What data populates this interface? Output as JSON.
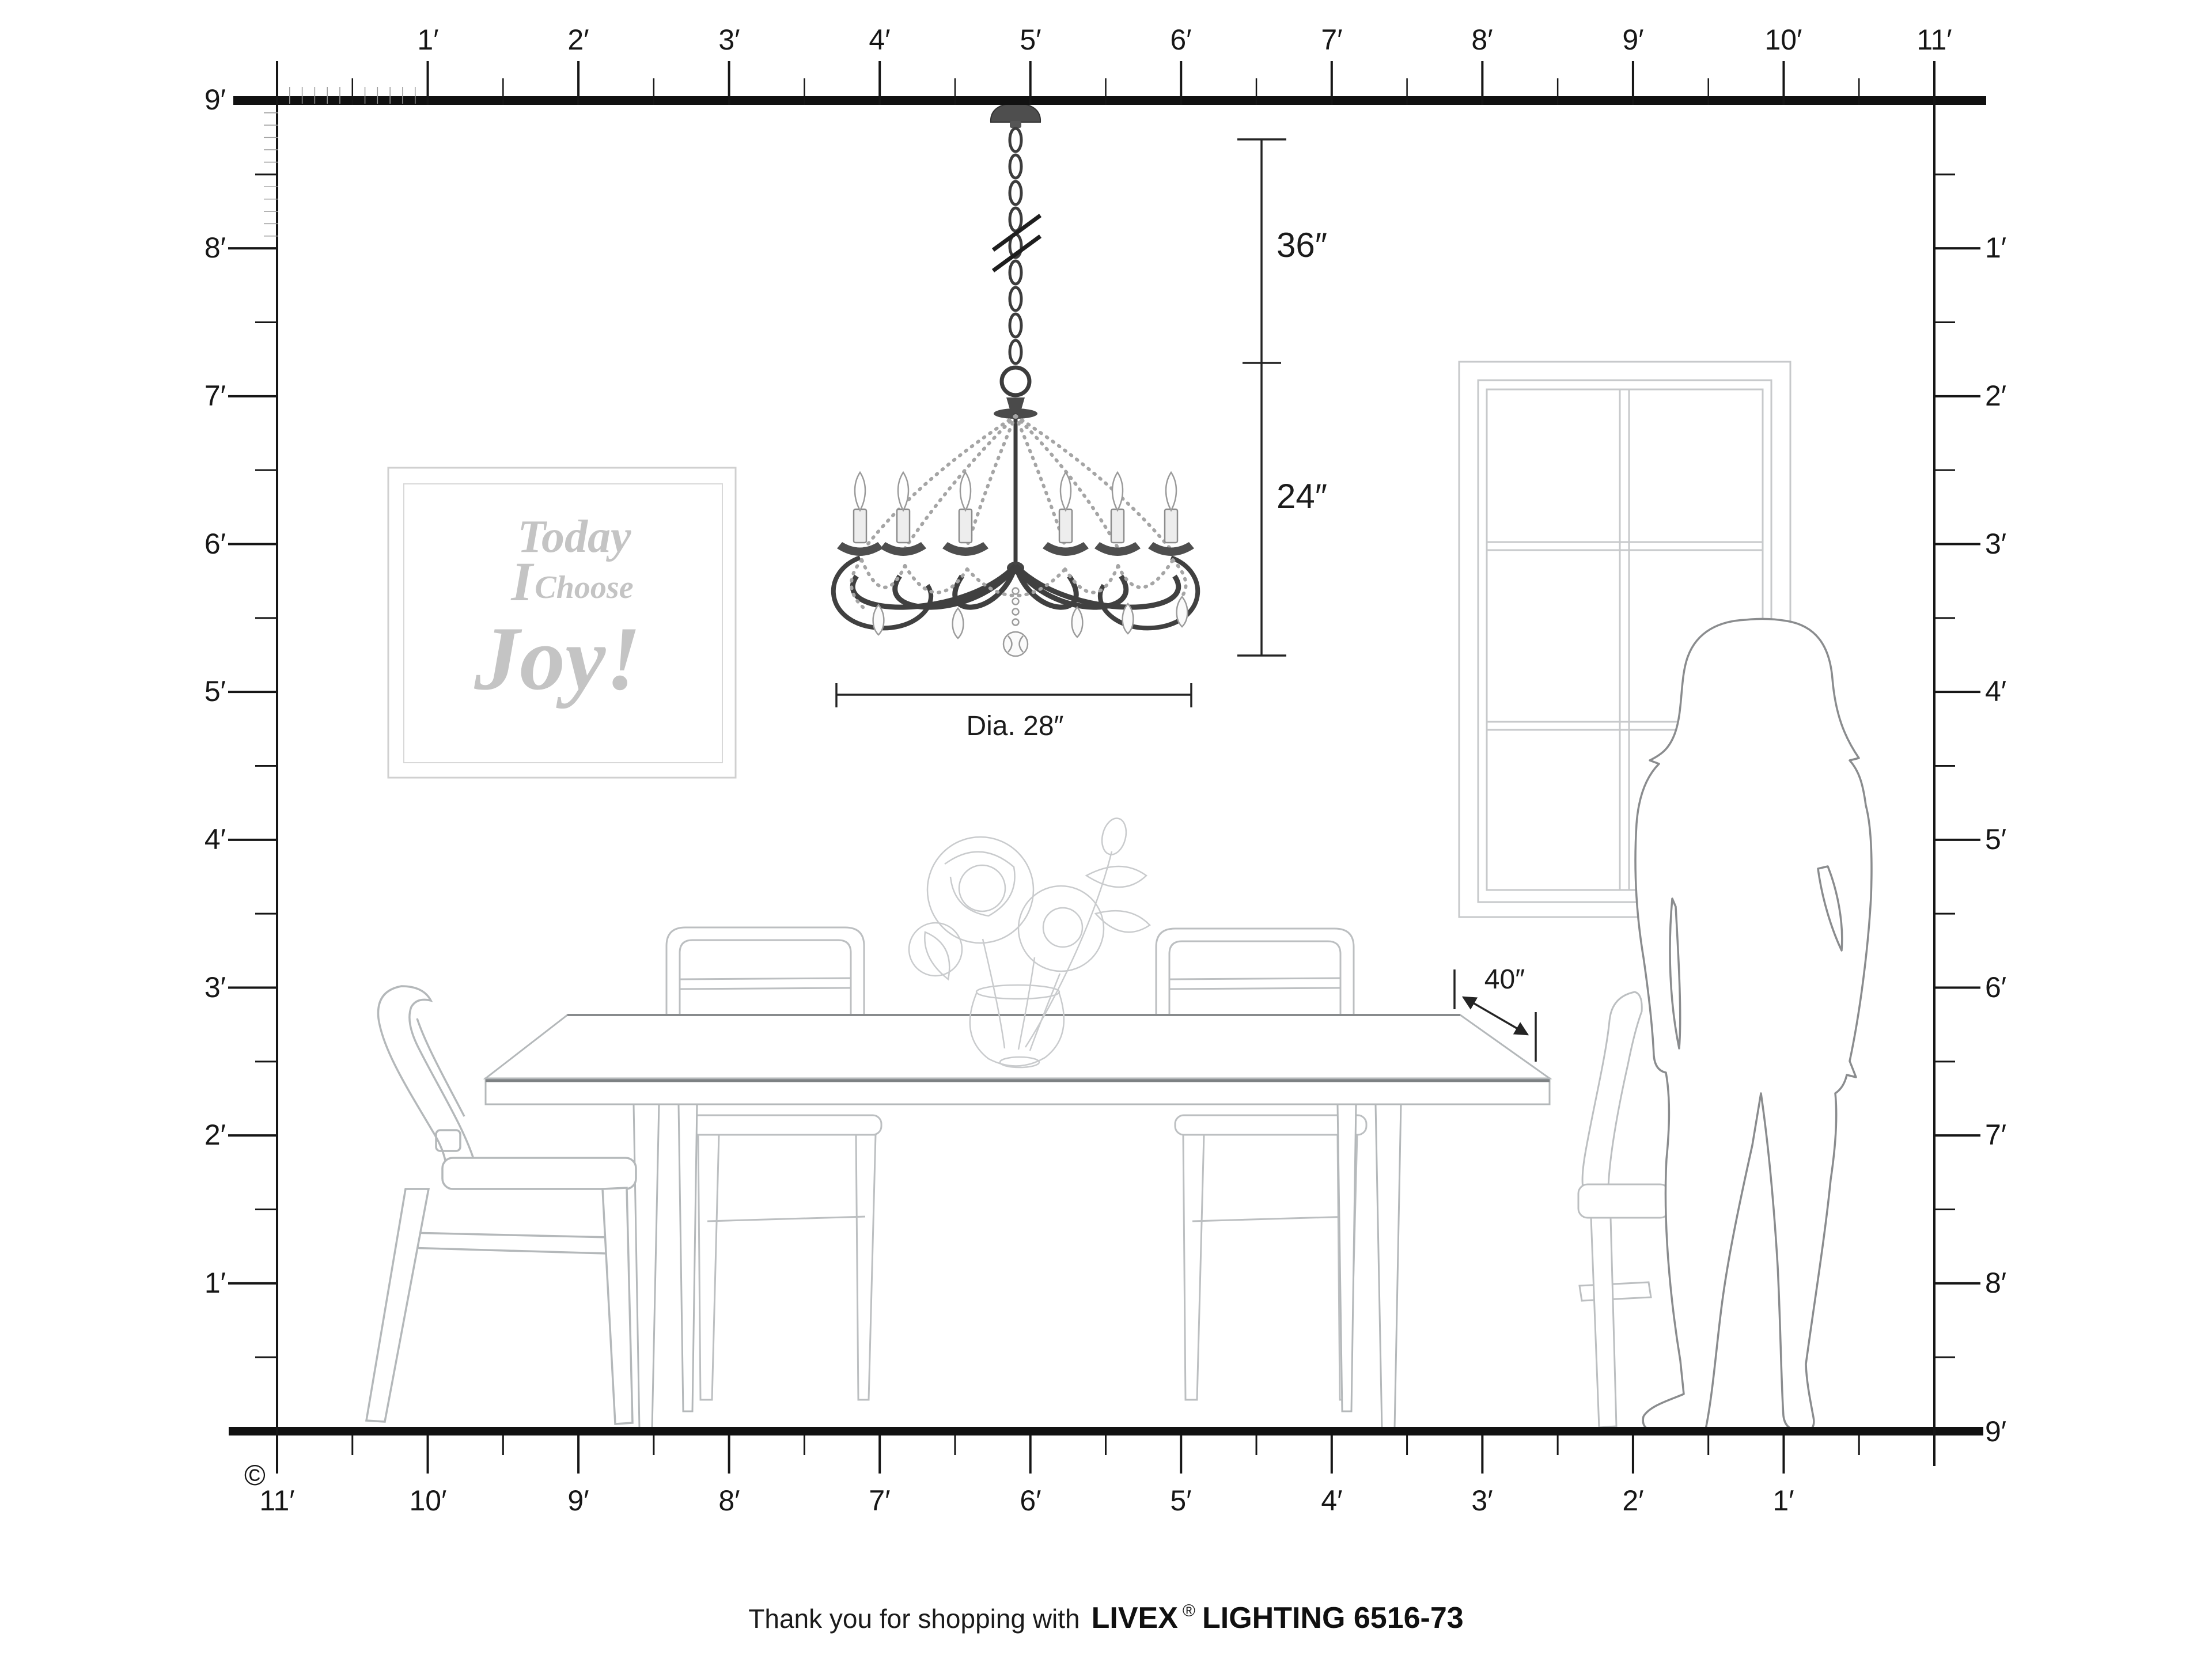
{
  "rulers": {
    "top": {
      "labels": [
        "1′",
        "2′",
        "3′",
        "4′",
        "5′",
        "6′",
        "7′",
        "8′",
        "9′",
        "10′",
        "11′"
      ]
    },
    "left": {
      "labels": [
        "9′",
        "8′",
        "7′",
        "6′",
        "5′",
        "4′",
        "3′",
        "2′",
        "1′"
      ]
    },
    "right": {
      "labels": [
        "1′",
        "2′",
        "3′",
        "4′",
        "5′",
        "6′",
        "7′",
        "8′",
        "9′"
      ]
    },
    "bottom": {
      "labels": [
        "11′",
        "10′",
        "9′",
        "8′",
        "7′",
        "6′",
        "5′",
        "4′",
        "3′",
        "2′",
        "1′"
      ]
    }
  },
  "dimensions": {
    "chain_length": "36″",
    "fixture_height": "24″",
    "fixture_diameter": "Dia. 28″",
    "table_clearance": "40″"
  },
  "wall_art": {
    "line1": "Today",
    "line2_pronoun": "I",
    "line2_verb": "Choose",
    "line3": "Joy!"
  },
  "footer": {
    "message": "Thank you for shopping with",
    "brand": "LIVEX",
    "registered_mark": "®",
    "product": "LIGHTING 6516-73"
  },
  "copyright_symbol": "©",
  "colors": {
    "ink": "#161616",
    "furniture_line": "#b4b8ba",
    "window_line": "#c7c9cb",
    "art_text": "#c4c4c4",
    "chandelier": "#3c3c3c",
    "figure_outline": "#8a8c8e"
  }
}
